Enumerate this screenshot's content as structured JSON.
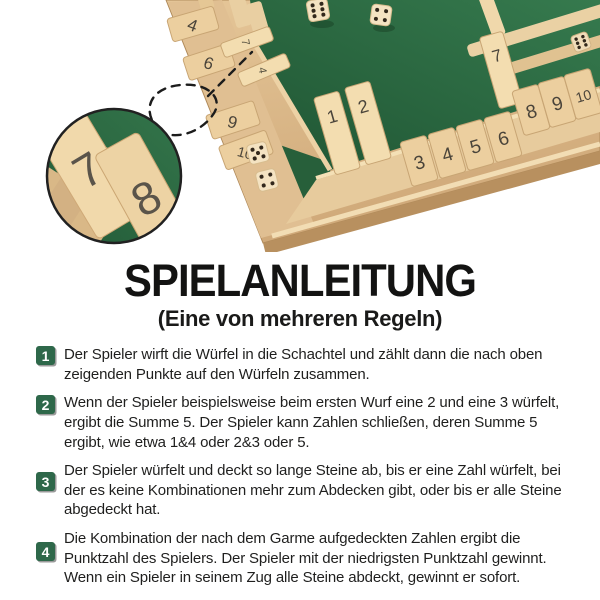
{
  "photo": {
    "alt": "Shut-the-Box Holz-Würfelspiel mit vier Spielerseiten",
    "colors": {
      "felt_green": "#2d6b44",
      "felt_dark": "#1f5533",
      "wood_light": "#f1d9ab",
      "wood_mid": "#dcbc8e",
      "wood_dark": "#bb9262",
      "tile_number": "#4a443a",
      "pip_brown": "#32281c"
    },
    "magnifier": {
      "tiles": [
        "7",
        "8"
      ]
    },
    "board": {
      "bottom_row_tiles": [
        {
          "n": "1",
          "state": "open"
        },
        {
          "n": "2",
          "state": "open"
        },
        {
          "n": "3",
          "state": "closed"
        },
        {
          "n": "4",
          "state": "closed"
        },
        {
          "n": "5",
          "state": "closed"
        },
        {
          "n": "6",
          "state": "closed"
        },
        {
          "n": "7",
          "state": "open"
        },
        {
          "n": "8",
          "state": "closed"
        },
        {
          "n": "9",
          "state": "closed"
        },
        {
          "n": "10",
          "state": "closed"
        }
      ],
      "left_row_tiles": [
        {
          "n": "4",
          "state": "closed"
        },
        {
          "n": "6",
          "state": "closed"
        },
        {
          "n": "7",
          "state": "open"
        },
        {
          "n": "4",
          "state": "open"
        },
        {
          "n": "9",
          "state": "closed"
        },
        {
          "n": "10",
          "state": "closed"
        }
      ],
      "dice": [
        {
          "value": 6,
          "location": "top-felt"
        },
        {
          "value": 4,
          "location": "top-felt"
        },
        {
          "value": 5,
          "location": "corner-felt"
        },
        {
          "value": 4,
          "location": "corner-felt"
        },
        {
          "value": 6,
          "location": "right-edge"
        }
      ]
    }
  },
  "instructions": {
    "title": "SPIELANLEITUNG",
    "subtitle": "(Eine von mehreren Regeln)",
    "accent_color": "#2e684a",
    "steps": [
      {
        "number": "1",
        "text": "Der Spieler wirft die Würfel in die Schachtel und zählt dann die nach oben zeigenden Punkte auf den Würfeln zusammen."
      },
      {
        "number": "2",
        "text": "Wenn der Spieler beispielsweise beim ersten Wurf eine 2 und eine 3 würfelt, ergibt die Summe 5. Der Spieler kann Zahlen schließen, deren Summe 5 ergibt, wie etwa 1&4 oder 2&3 oder 5."
      },
      {
        "number": "3",
        "text": "Der Spieler würfelt und deckt so lange Steine ab, bis er eine Zahl würfelt, bei der es keine Kombinationen mehr zum Abdecken gibt, oder bis er alle Steine abgedeckt hat."
      },
      {
        "number": "4",
        "text": "Die Kombination der nach dem Garme aufgedeckten Zahlen ergibt die Punktzahl des Spielers. Der Spieler mit der niedrigsten Punktzahl gewinnt. Wenn ein Spieler in seinem Zug alle Steine abdeckt, gewinnt er sofort."
      }
    ]
  }
}
